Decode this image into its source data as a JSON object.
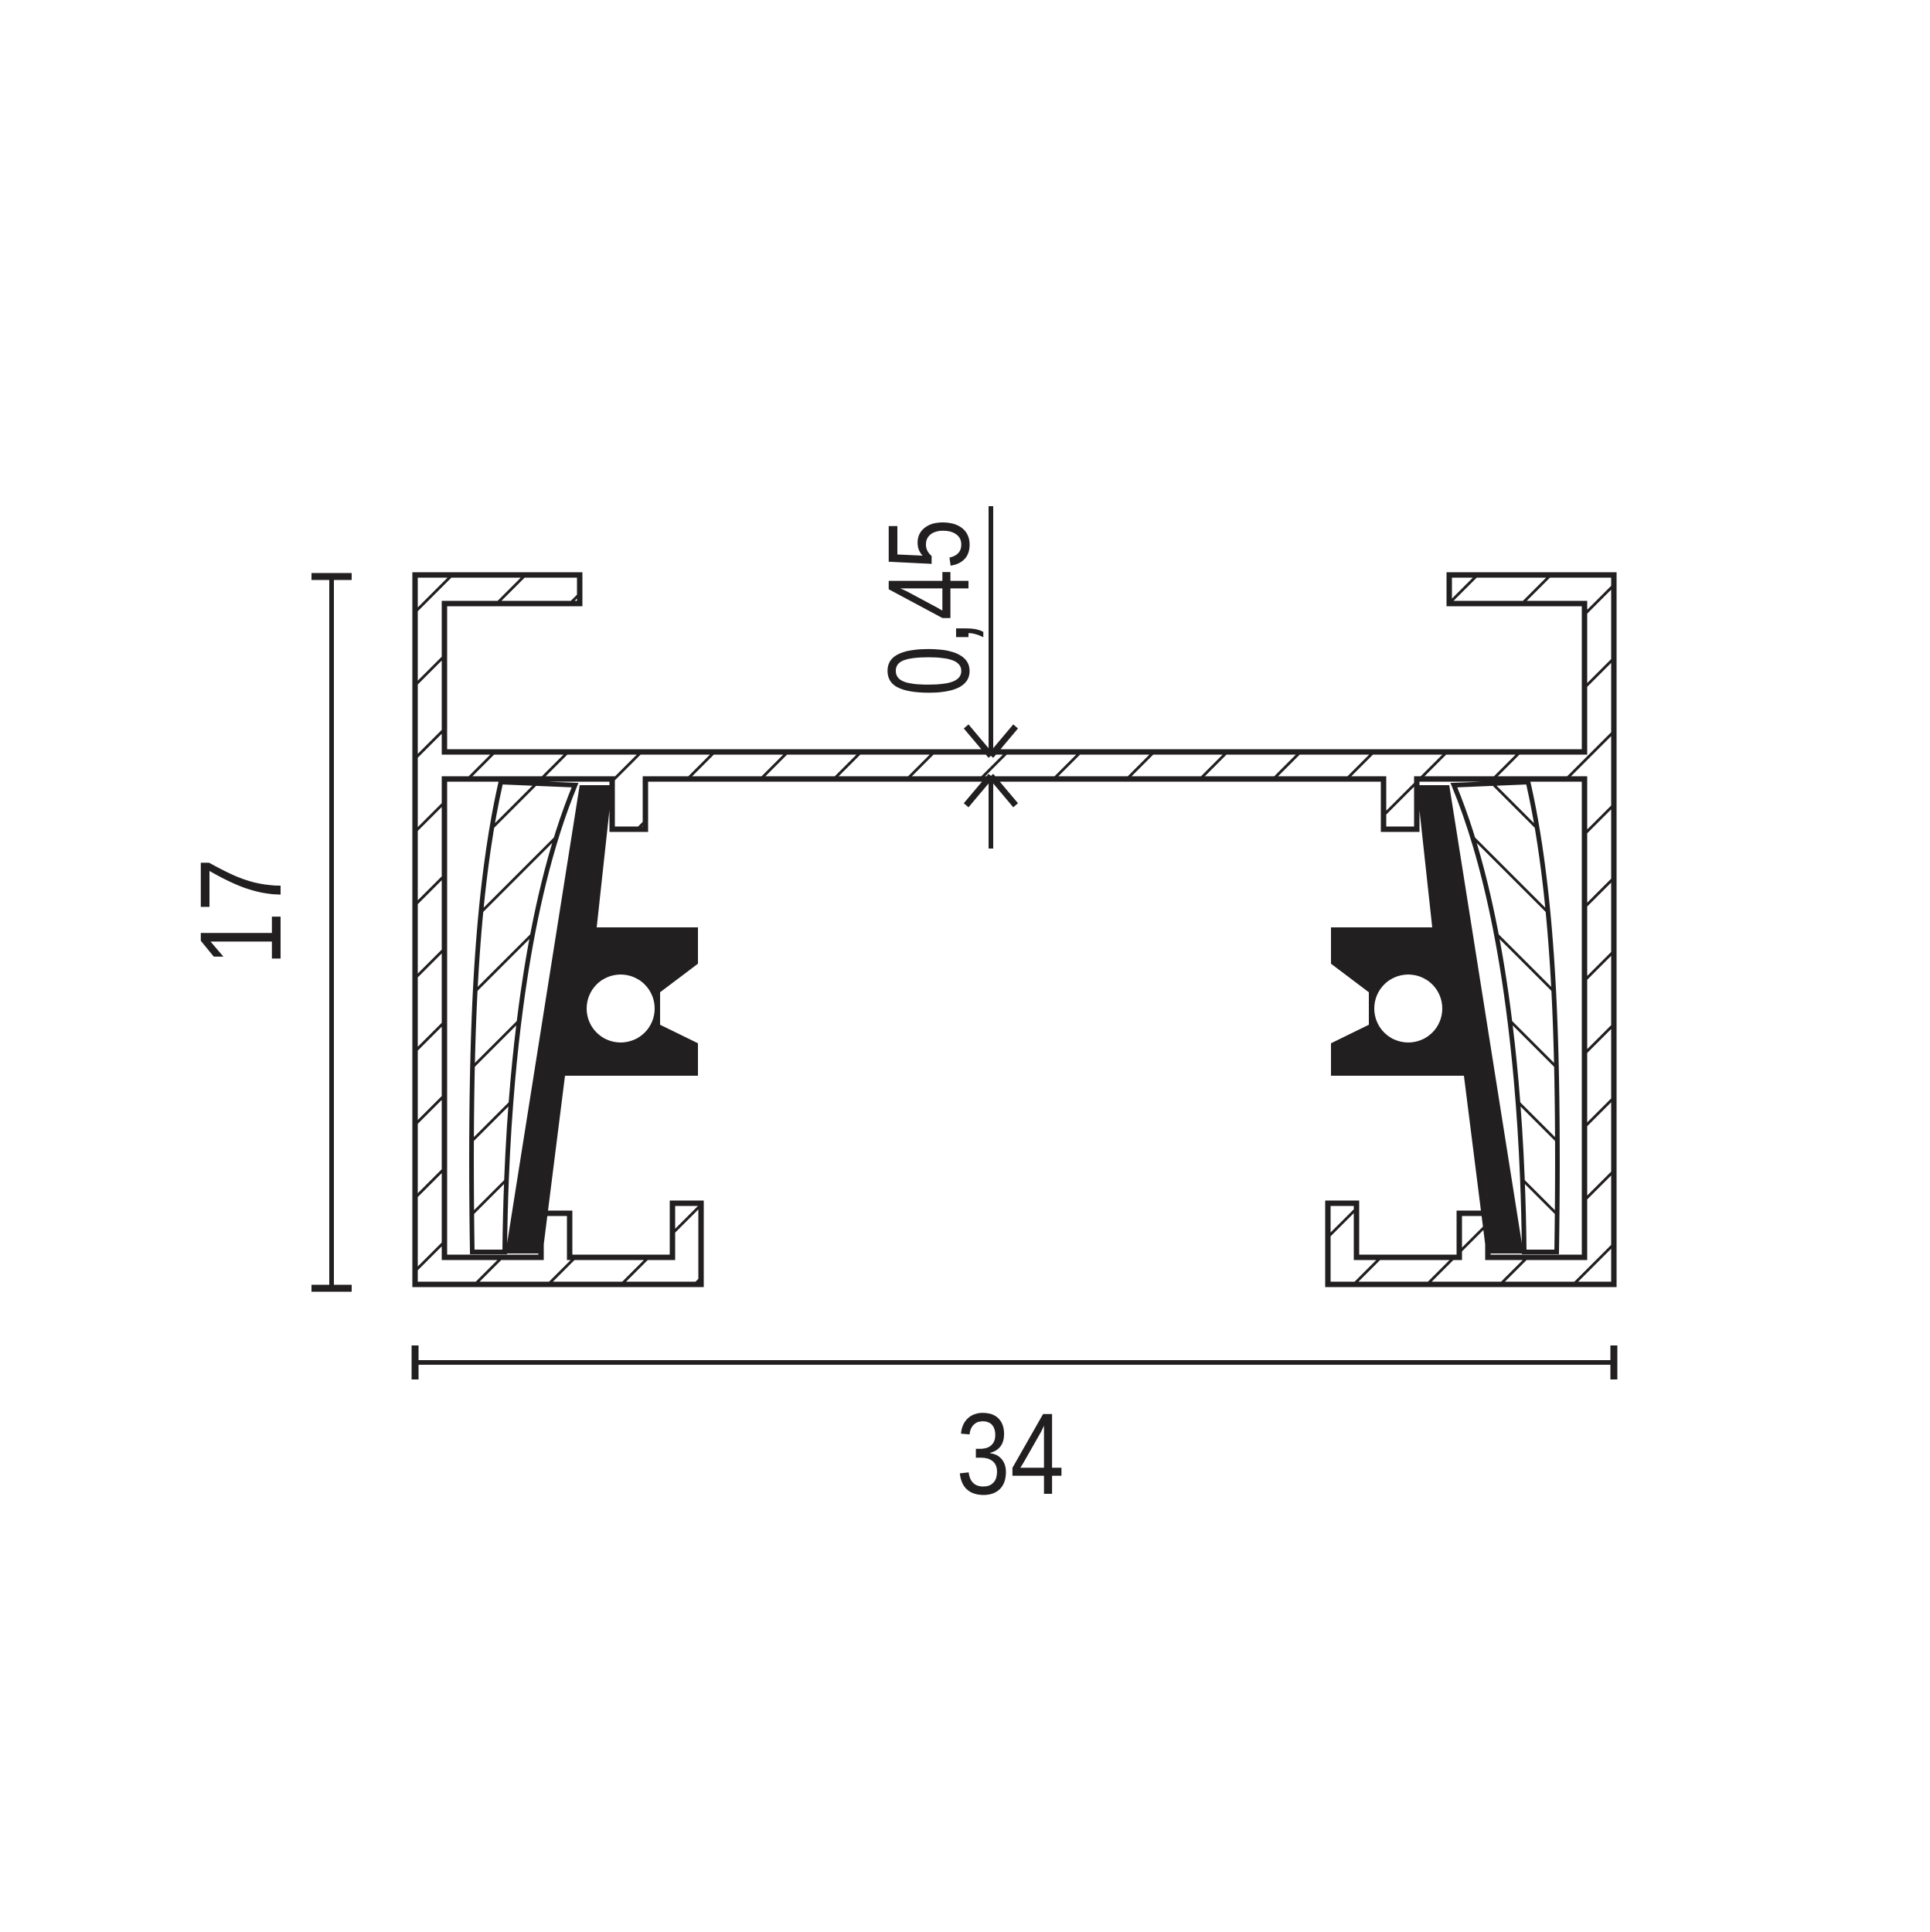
{
  "drawing": {
    "dimensions": {
      "width": {
        "label": "34"
      },
      "height": {
        "label": "17"
      },
      "web_thickness": {
        "label": "0,45"
      }
    },
    "colors": {
      "ink": "#221f20",
      "paper": "#ffffff"
    }
  }
}
